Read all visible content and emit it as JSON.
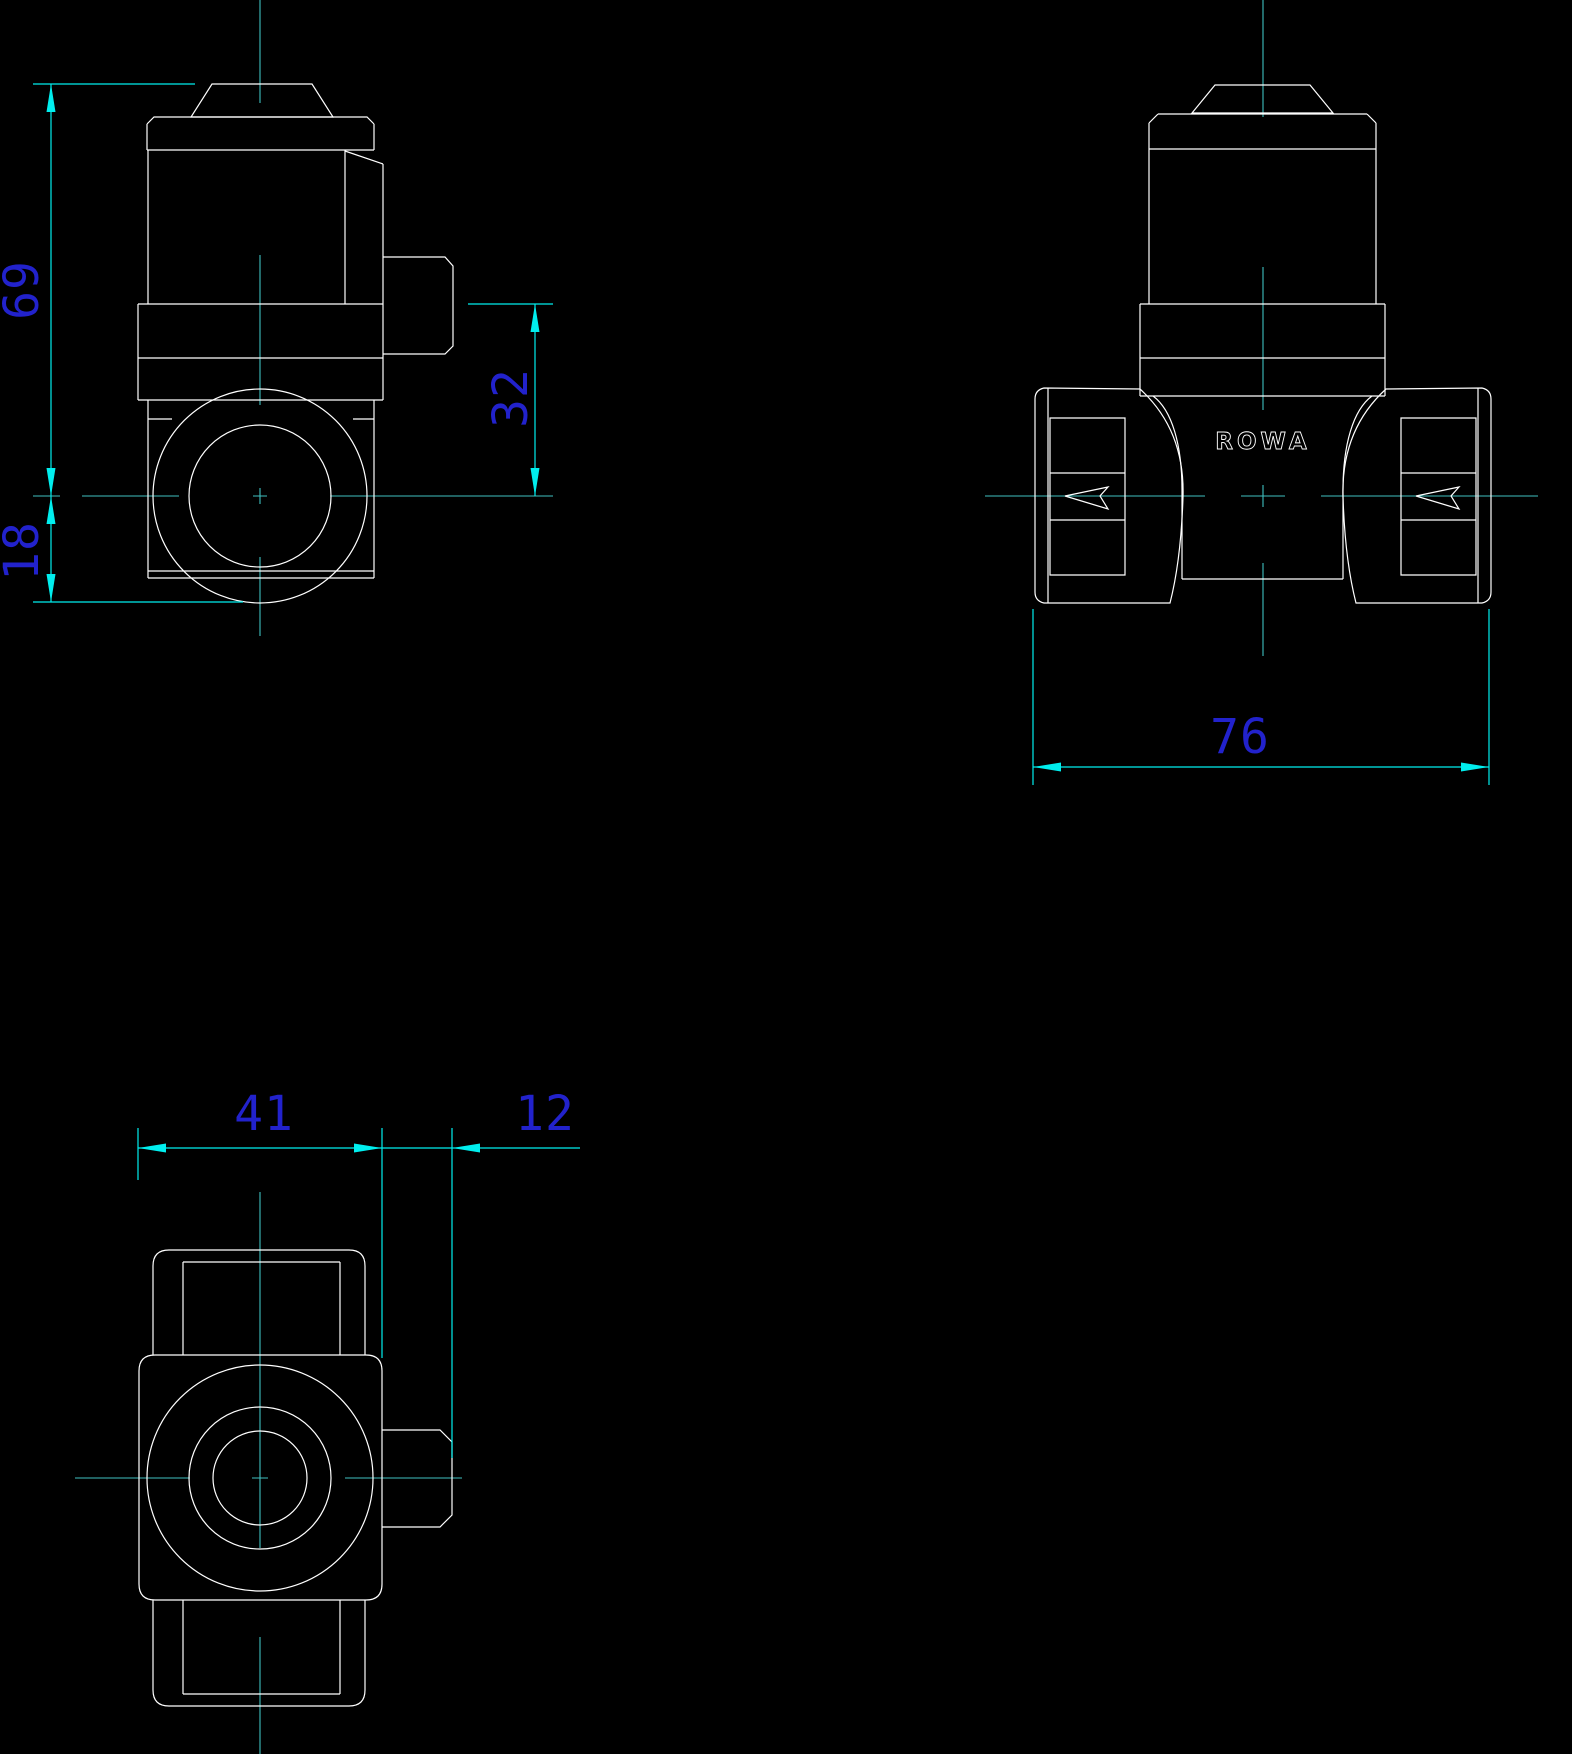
{
  "canvas": {
    "background": "#000000",
    "width": "1572",
    "height": "1754"
  },
  "drawing": {
    "logo_text": "ROWA",
    "colors": {
      "geometry": "#ffffff",
      "dimension_lines": "#00eeee",
      "centerlines": "#3fbfbf",
      "dimension_text": "#2222cc"
    },
    "views": {
      "side_view": {
        "dim_overall_height": "69",
        "dim_port_center_height": "18",
        "dim_outlet_height": "32"
      },
      "front_view": {
        "dim_overall_width": "76"
      },
      "top_view": {
        "dim_body_width": "41",
        "dim_stub_depth": "12"
      }
    }
  }
}
